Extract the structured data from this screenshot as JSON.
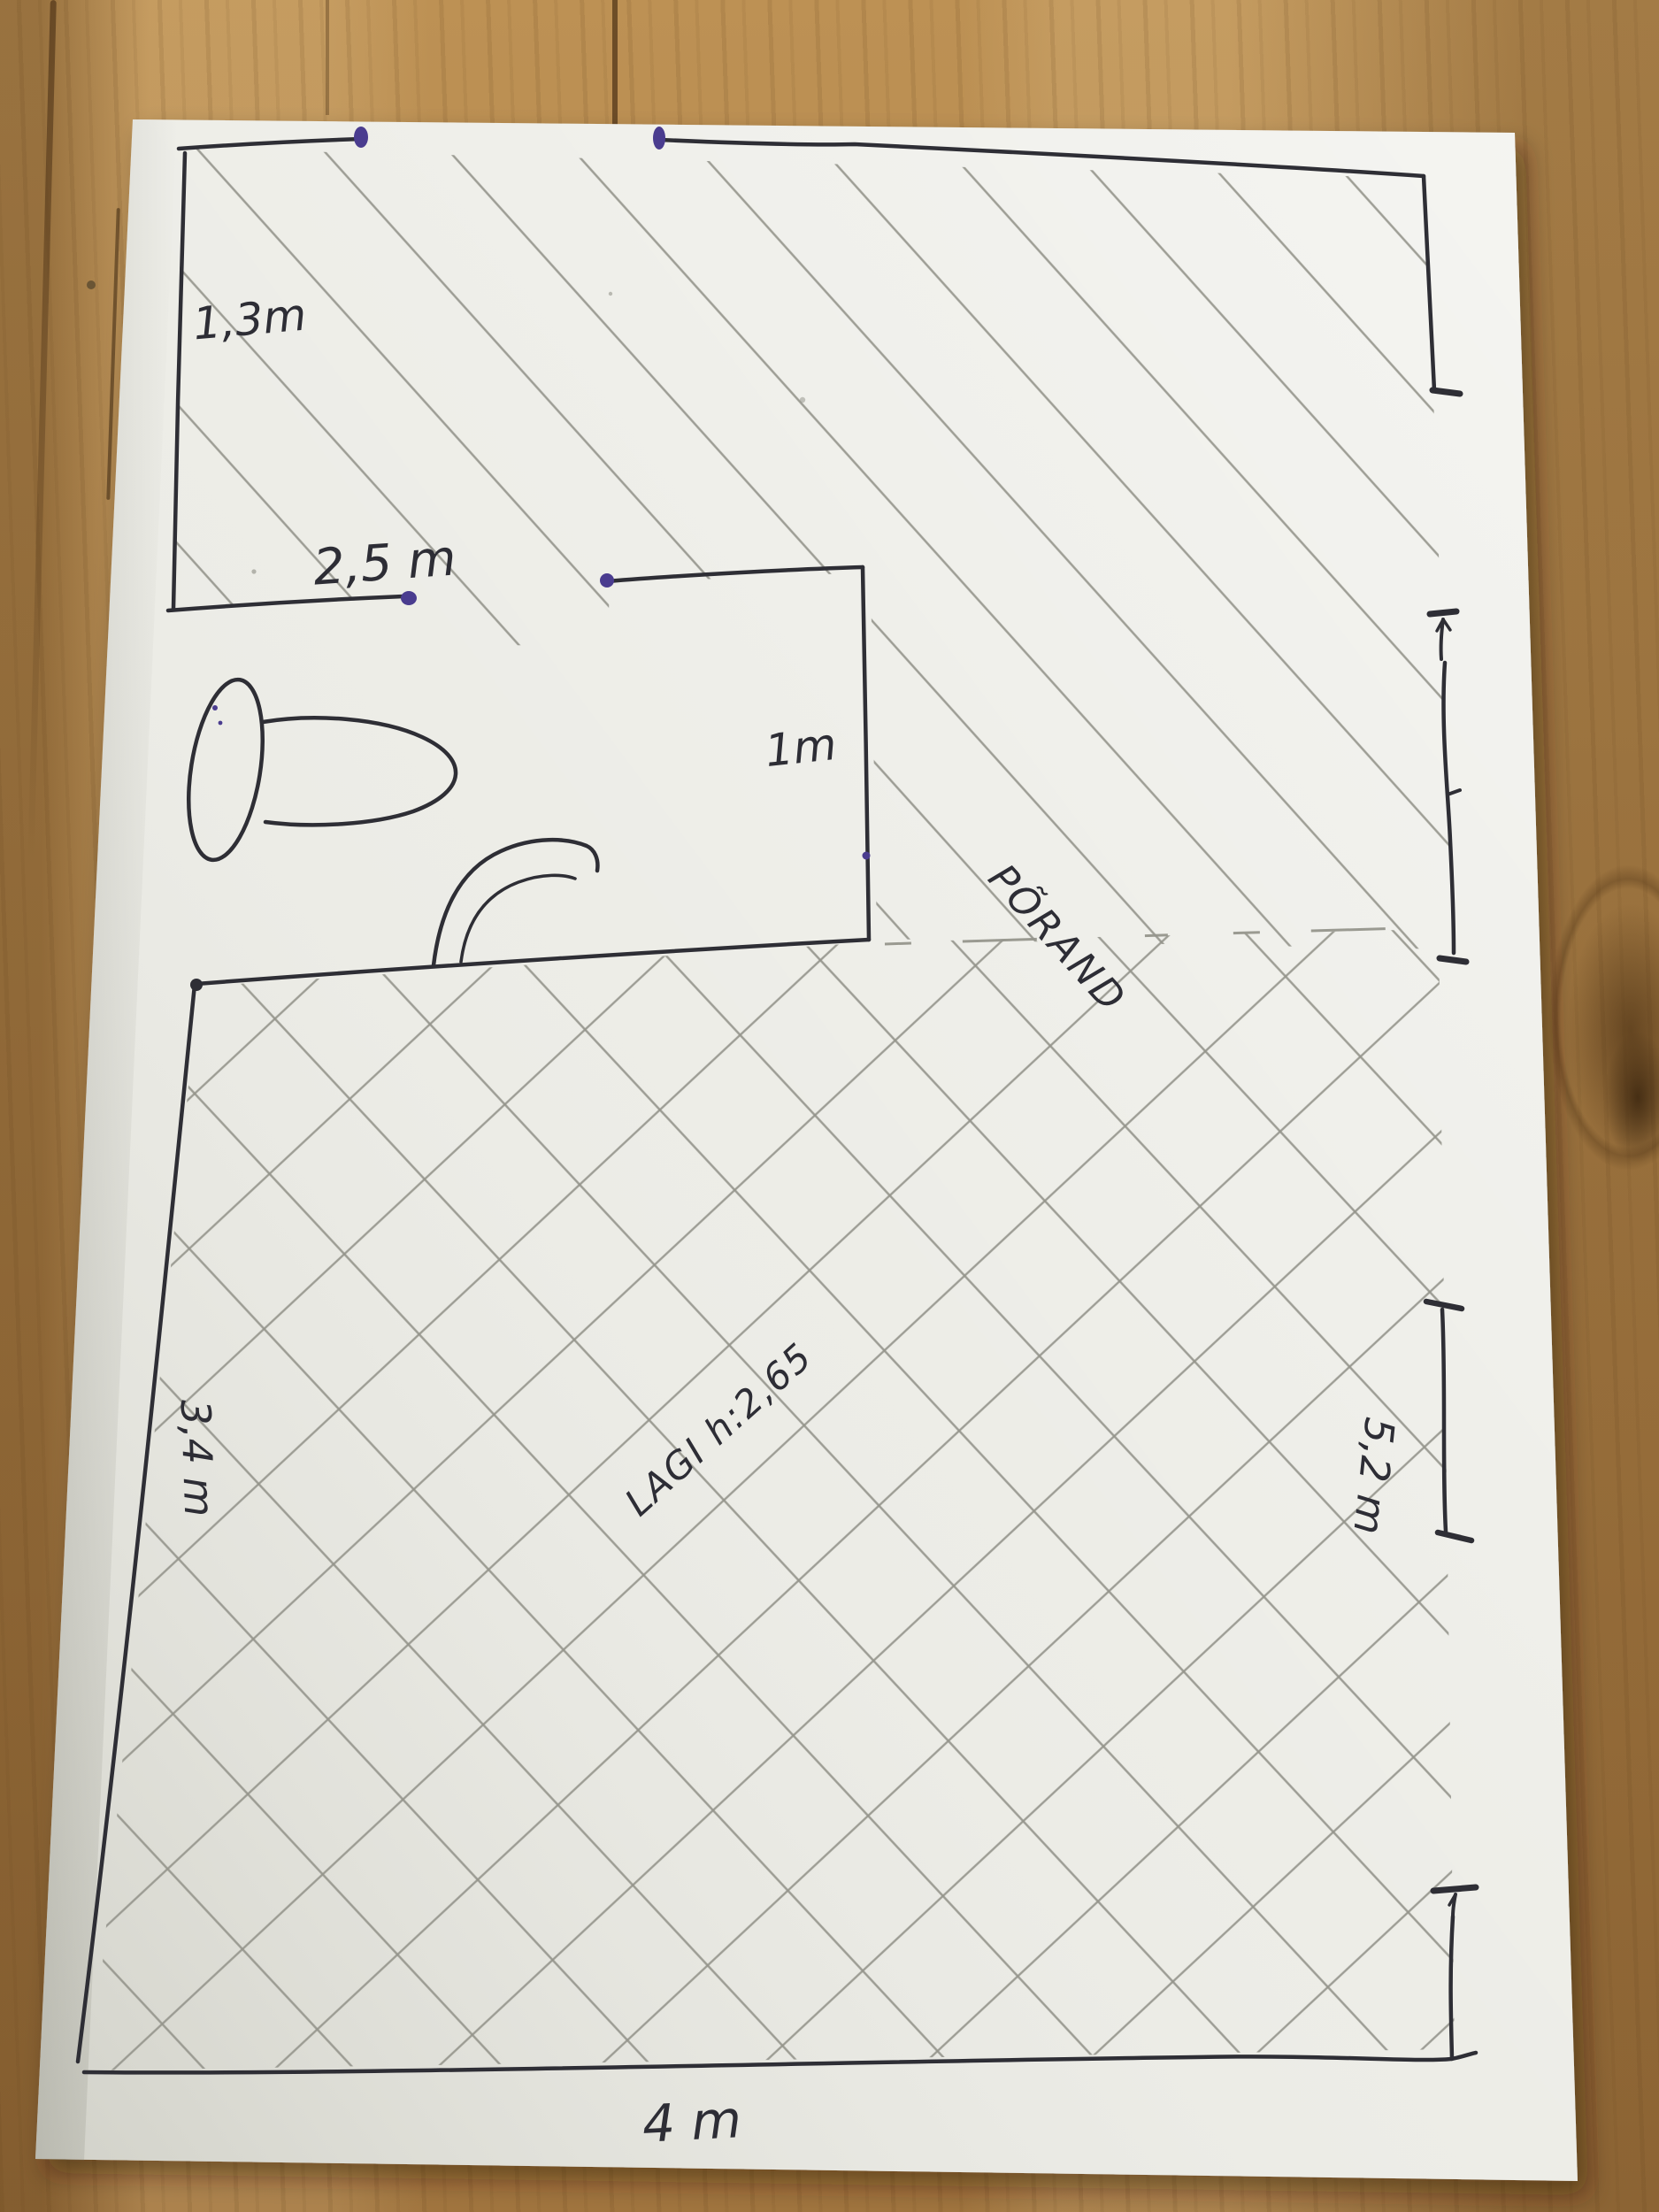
{
  "sketch": {
    "dimension_labels": [
      {
        "id": "top-left-room-height",
        "text": "1,3m"
      },
      {
        "id": "top-left-room-width",
        "text": "2,5 m"
      },
      {
        "id": "wc-room-width",
        "text": "1m"
      },
      {
        "id": "main-room-left-side",
        "text": "3,4 m"
      },
      {
        "id": "main-room-right-side",
        "text": "5,2 m"
      },
      {
        "id": "main-room-bottom-side",
        "text": "4 m"
      }
    ],
    "area_labels": [
      {
        "id": "floor-label",
        "text": "PÕRAND"
      },
      {
        "id": "ceiling-height-label",
        "text": "LAGI h:2,65"
      }
    ]
  },
  "colors": {
    "ink": "#2e2e35",
    "pencil": "#95958c",
    "purple_ink": "#4a3c8f",
    "paper": "#ecece6"
  }
}
